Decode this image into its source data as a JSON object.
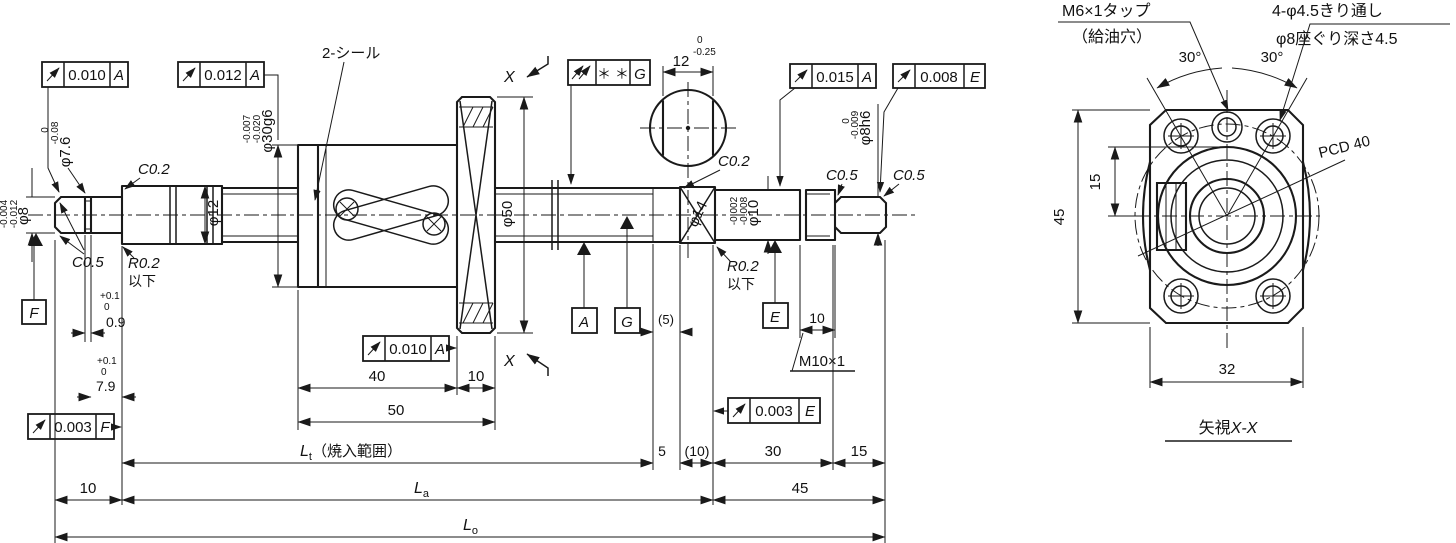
{
  "m": {
    "f1_val": "0.010",
    "f1_datum": "A",
    "f2_val": "0.012",
    "f2_datum": "A",
    "f3_val": "＊ ＊",
    "f3_datum": "G",
    "f4_val": "0.015",
    "f4_datum": "A",
    "f5_val": "0.008",
    "f5_datum": "E",
    "f6_val": "0.010",
    "f6_datum": "A",
    "f7_val": "0.003",
    "f7_datum": "F",
    "f8_val": "0.003",
    "f8_datum": "E",
    "datum_a": "A",
    "datum_g": "G",
    "datum_e": "E",
    "datum_f": "F",
    "seal": "2-シール",
    "phi76": "φ7.6",
    "phi76_t1": "0",
    "phi76_t2": "-0.08",
    "phi8": "φ8",
    "phi8_t1": "-0.004",
    "phi8_t2": "-0.012",
    "c02": "C0.2",
    "c05": "C0.5",
    "r02": "R0.2",
    "ika": "以下",
    "c02_b": "C0.2",
    "r02_b": "R0.2",
    "ika_b": "以下",
    "c05_b": "C0.5",
    "c05_c": "C0.5",
    "d09": "0.9",
    "d09_t1": "+0.1",
    "d09_t2": "0",
    "d79": "7.9",
    "d79_t1": "+0.1",
    "d79_t2": "0",
    "phi12": "φ12",
    "phi30": "φ30g6",
    "phi30_t1": "-0.007",
    "phi30_t2": "-0.020",
    "d40": "40",
    "d10n": "10",
    "d50": "50",
    "phi50": "φ50",
    "d12": "12",
    "d12_t1": "0",
    "d12_t2": "-0.25",
    "phi14": "φ14",
    "phi10": "φ10",
    "phi10_t1": "-0.002",
    "phi10_t2": "-0.008",
    "phi8h6": "φ8h6",
    "phi8h6_t1": "0",
    "phi8h6_t2": "-0.009",
    "d5p": "(5)",
    "d10m": "10",
    "m10": "M10×1",
    "d10L": "10",
    "d5": "5",
    "d10p": "(10)",
    "d30": "30",
    "d15": "15",
    "d45": "45",
    "lt_L": "L",
    "lt_sub": "t",
    "lt_note": "（焼入範囲）",
    "la_L": "L",
    "la_sub": "a",
    "lo_L": "L",
    "lo_sub": "o",
    "x1": "X",
    "x2": "X"
  },
  "e": {
    "m6_1": "M6×1タップ",
    "m6_2": "（給油穴）",
    "holes_1": "4-φ4.5きり通し",
    "holes_2": "φ8座ぐり深さ4.5",
    "deg_l": "30°",
    "deg_r": "30°",
    "pcd": "PCD 40",
    "d15": "15",
    "d45": "45",
    "d32": "32",
    "title_1": "矢視",
    "title_2": "X-X"
  }
}
